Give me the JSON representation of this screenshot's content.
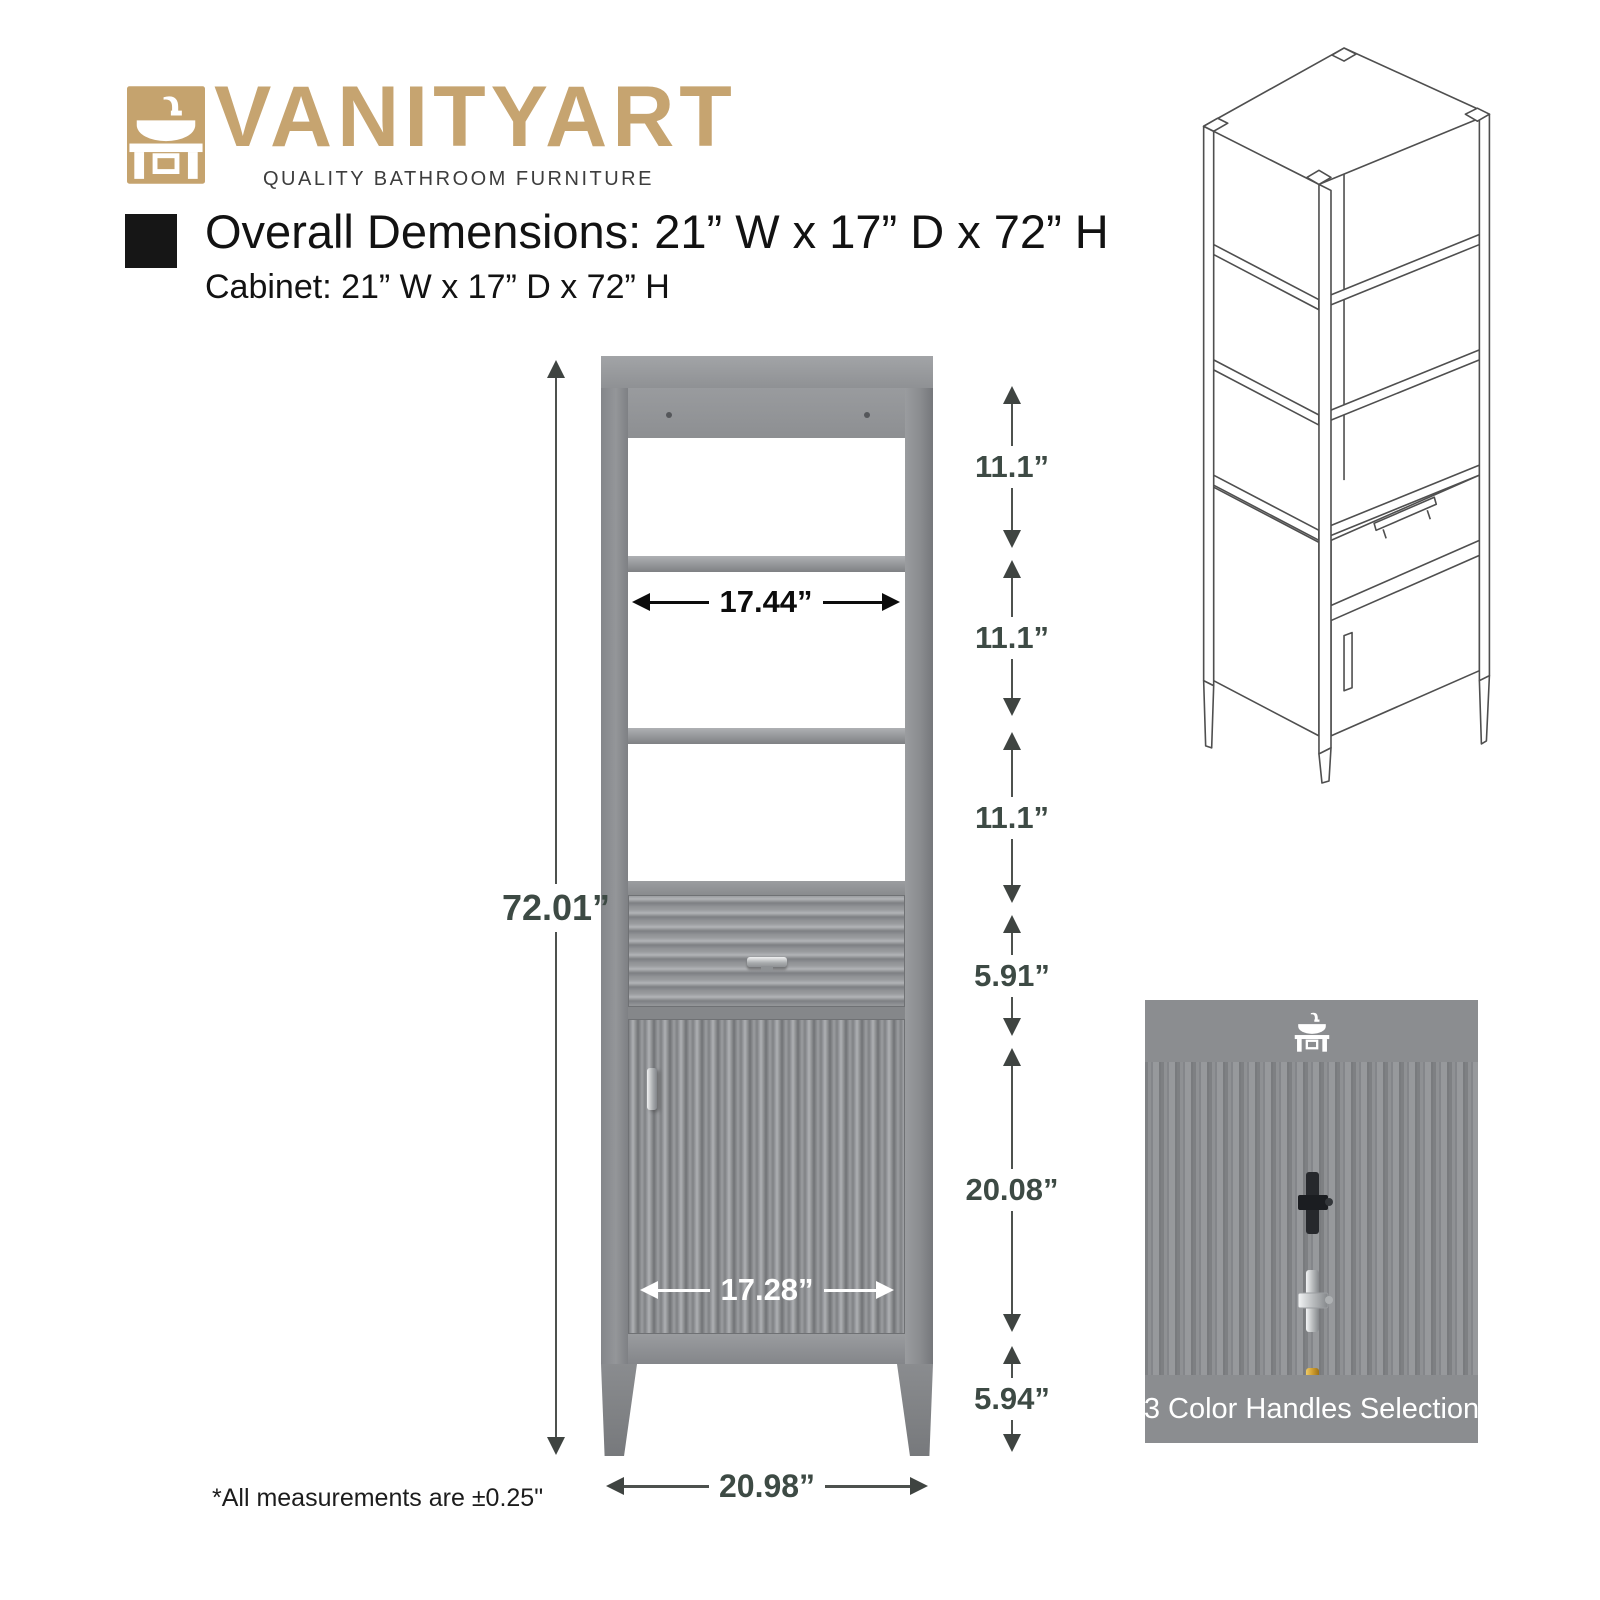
{
  "brand": {
    "name": "VANITYART",
    "tagline": "QUALITY BATHROOM FURNITURE"
  },
  "header": {
    "title": "Overall Demensions: 21” W x 17” D x 72” H",
    "subtitle": "Cabinet: 21” W x 17” D x 72” H"
  },
  "diagram": {
    "height_label": "72.01”",
    "shelf_inner_width_label": "17.44”",
    "door_width_label": "17.28”",
    "base_width_label": "20.98”",
    "right_segments": [
      {
        "label": "11.1”"
      },
      {
        "label": "11.1”"
      },
      {
        "label": "11.1”"
      },
      {
        "label": "5.91”"
      },
      {
        "label": "20.08”"
      },
      {
        "label": "5.94”"
      }
    ]
  },
  "handles_panel": {
    "caption": "3 Color Handles Selection",
    "options": [
      {
        "name": "black",
        "color": "#26282c"
      },
      {
        "name": "chrome",
        "color": "#c4c7c9"
      },
      {
        "name": "gold",
        "color": "#cf9d2f"
      }
    ]
  },
  "footnote": "*All measurements are ±0.25\"",
  "colors": {
    "brand_gold": "#c6a470",
    "dimension_text": "#3d4a44",
    "cabinet_gray": "#8e9093",
    "panel_band_gray": "#8b8d90"
  }
}
